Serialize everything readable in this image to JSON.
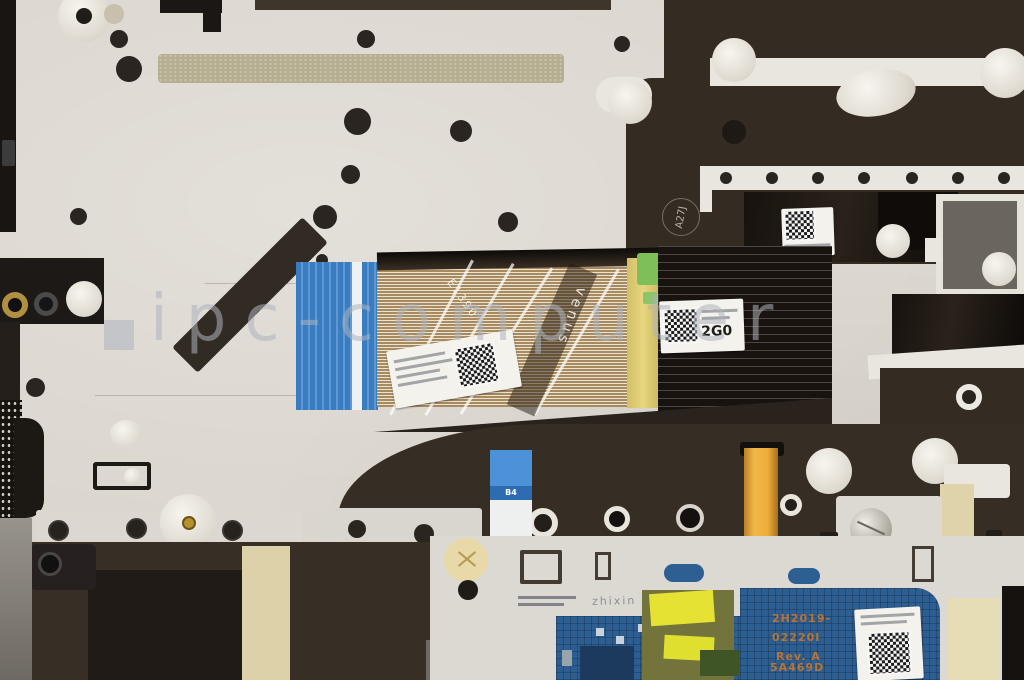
{
  "photo": {
    "watermark_text": "ipc-computer"
  },
  "markings": {
    "plate_stamp": "A27J",
    "ribbon_brand_vertical": "venus",
    "ribbon_code_diagonal": "E1390",
    "fold_label_code": "2G0",
    "ffc_stiffener_tag": "B4",
    "touchpad_plate_stamp": "zhixin E5180A",
    "touchpad_code_lines": [
      "2H2019-",
      "02220I",
      "Rev. A",
      "5A469D"
    ]
  }
}
